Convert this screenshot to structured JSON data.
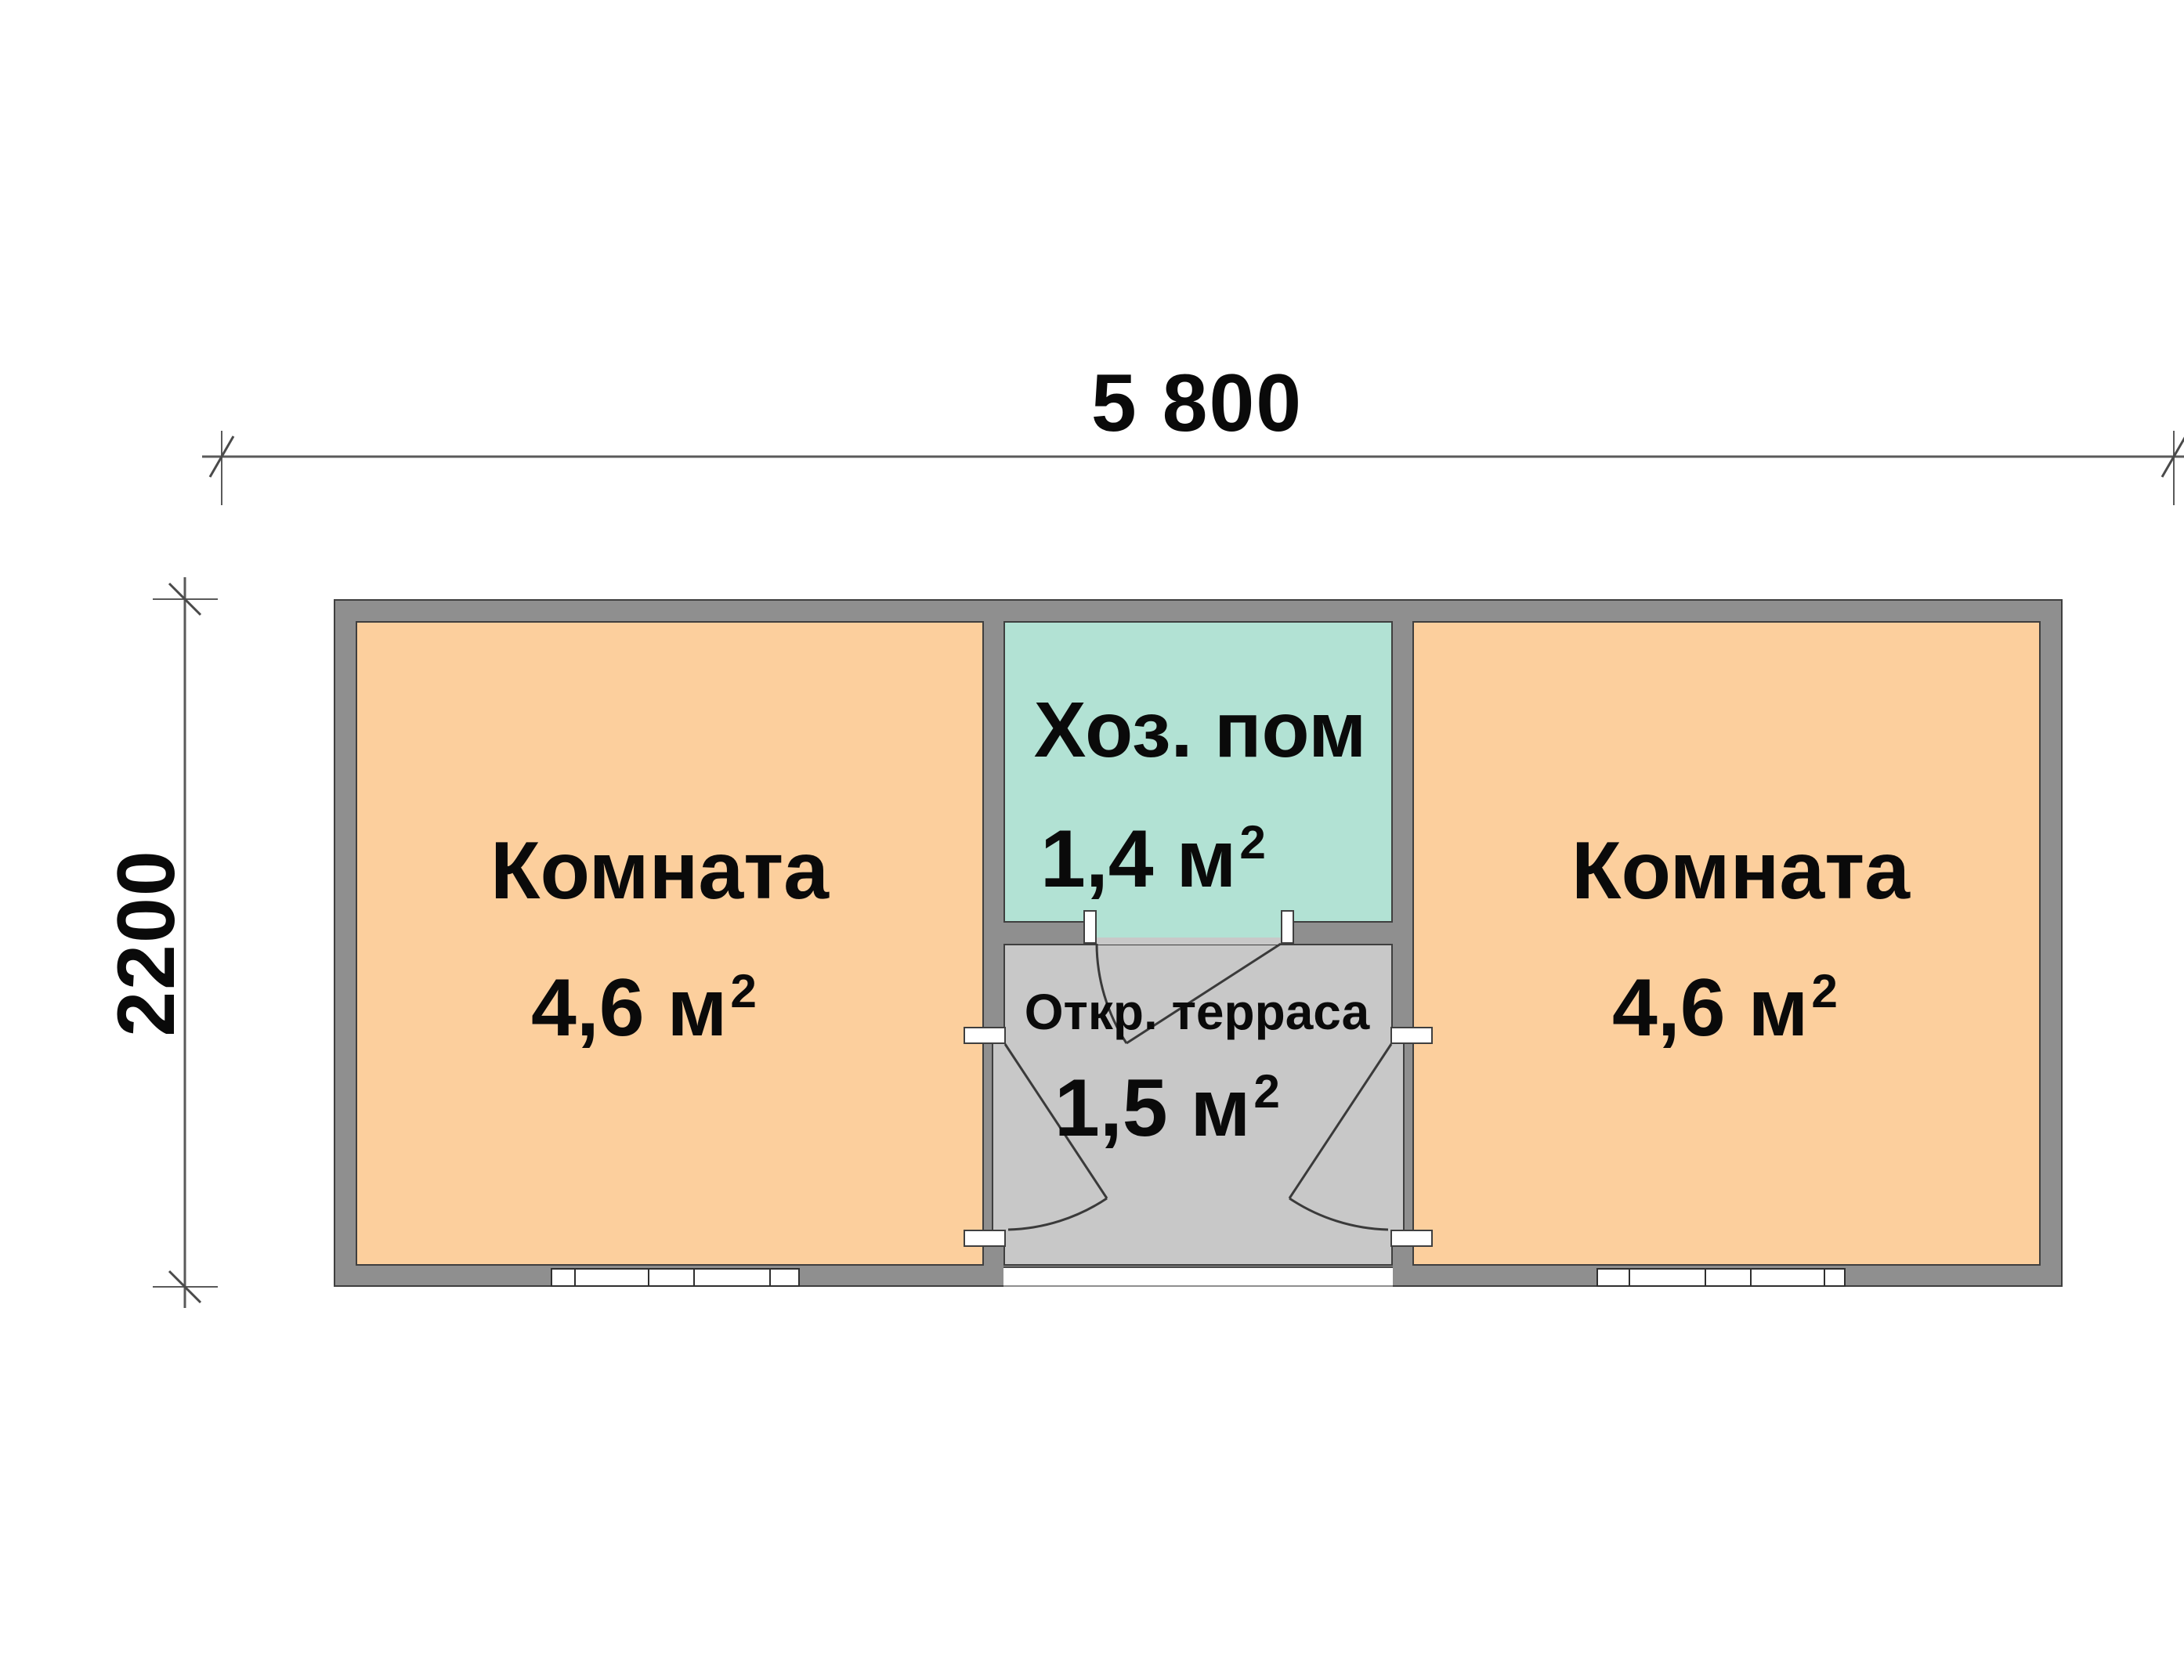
{
  "plan": {
    "type": "floor-plan",
    "dimensions": {
      "top_width_label": "5 800",
      "left_height_label": "2200"
    },
    "rooms": {
      "left": {
        "name": "Комната",
        "area": "4,6 м",
        "area_sup": "2"
      },
      "utility": {
        "name": "Хоз. пом",
        "area": "1,4 м",
        "area_sup": "2"
      },
      "terrace": {
        "name": "Откр. терраса",
        "area": "1,5 м",
        "area_sup": "2"
      },
      "right": {
        "name": "Комната",
        "area": "4,6 м",
        "area_sup": "2"
      }
    },
    "colors": {
      "room_fill": "#fccf9d",
      "utility_fill": "#b2e2d4",
      "terrace_fill": "#c8c8c8",
      "wall_fill": "#8f8f8f",
      "outline": "#3f3f3f",
      "dimension_line": "#5a5a5a",
      "door_line": "#3a3a3a",
      "window_fill": "#ffffff",
      "text": "#0a0a0a",
      "background": "#ffffff"
    }
  }
}
